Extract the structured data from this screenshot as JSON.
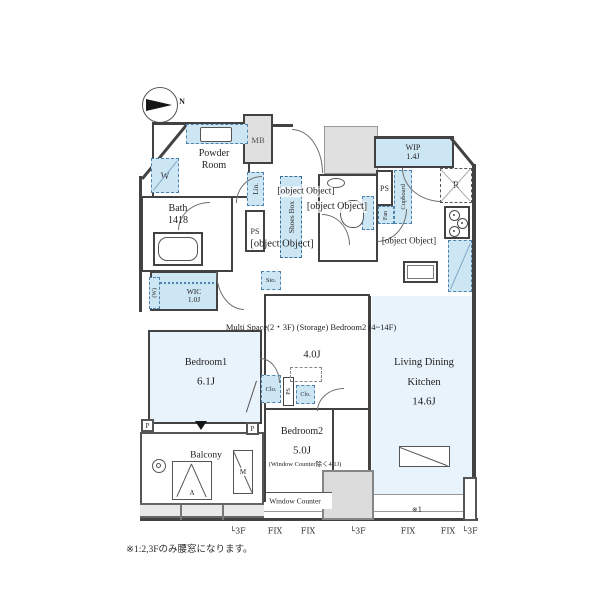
{
  "compass": {
    "label": "N"
  },
  "rooms": {
    "powder_room": {
      "name": "Powder\nRoom"
    },
    "bath": {
      "name": "Bath\n1418"
    },
    "entrance": {
      "name": "Entrance"
    },
    "hall": {
      "name": "Hall"
    },
    "toilet": {
      "name": "Toilet"
    },
    "wip": {
      "name": "WIP\n1.4J"
    },
    "kitchen": {
      "name": "(Kitchen 3.5J)"
    },
    "wic": {
      "name": "WIC\n1.0J"
    },
    "multi_space": {
      "name": "Multi Space(2・3F)\n(Storage)\nBedroom2 (4~14F)",
      "size": "4.0J"
    },
    "bedroom1": {
      "name": "Bedroom1",
      "size": "6.1J"
    },
    "bedroom2": {
      "name": "Bedroom2",
      "size": "5.0J",
      "note": "(Window Counter除く4.1J)"
    },
    "ldk": {
      "name": "Living Dining\nKitchen",
      "size": "14.6J"
    },
    "balcony": {
      "name": "Balcony"
    },
    "window_counter": {
      "name": "Window Counter"
    }
  },
  "fixtures": {
    "mb": "MB",
    "lin": "Lin.",
    "ps_entrance": "PS",
    "shoes_box": "Shoes Box",
    "ps_kitchen": "PS",
    "fan": "Fan",
    "cupboard": "Cupboard",
    "fridge": "R",
    "sto": "Sto.",
    "washer": "W",
    "wic_window": "(W)",
    "clo_a": "Clo.",
    "ps_multi": "PS",
    "clo_b": "Clo.",
    "pillar_a": "P",
    "pillar_b": "P",
    "ac_outdoor": "A",
    "meter": "M"
  },
  "annotations": {
    "ref_mark": "※1",
    "windows": [
      "└3F",
      "FIX",
      "FIX",
      "└3F",
      "FIX",
      "FIX",
      "└3F"
    ],
    "note": "※1:2,3Fのみ腰窓になります。"
  },
  "colors": {
    "wall": "#424242",
    "room_fill": "#e9f3fb",
    "fixture_fill": "#cde6f4",
    "fixture_border": "#4e81ab",
    "gray_fill": "#e0e0e0"
  }
}
